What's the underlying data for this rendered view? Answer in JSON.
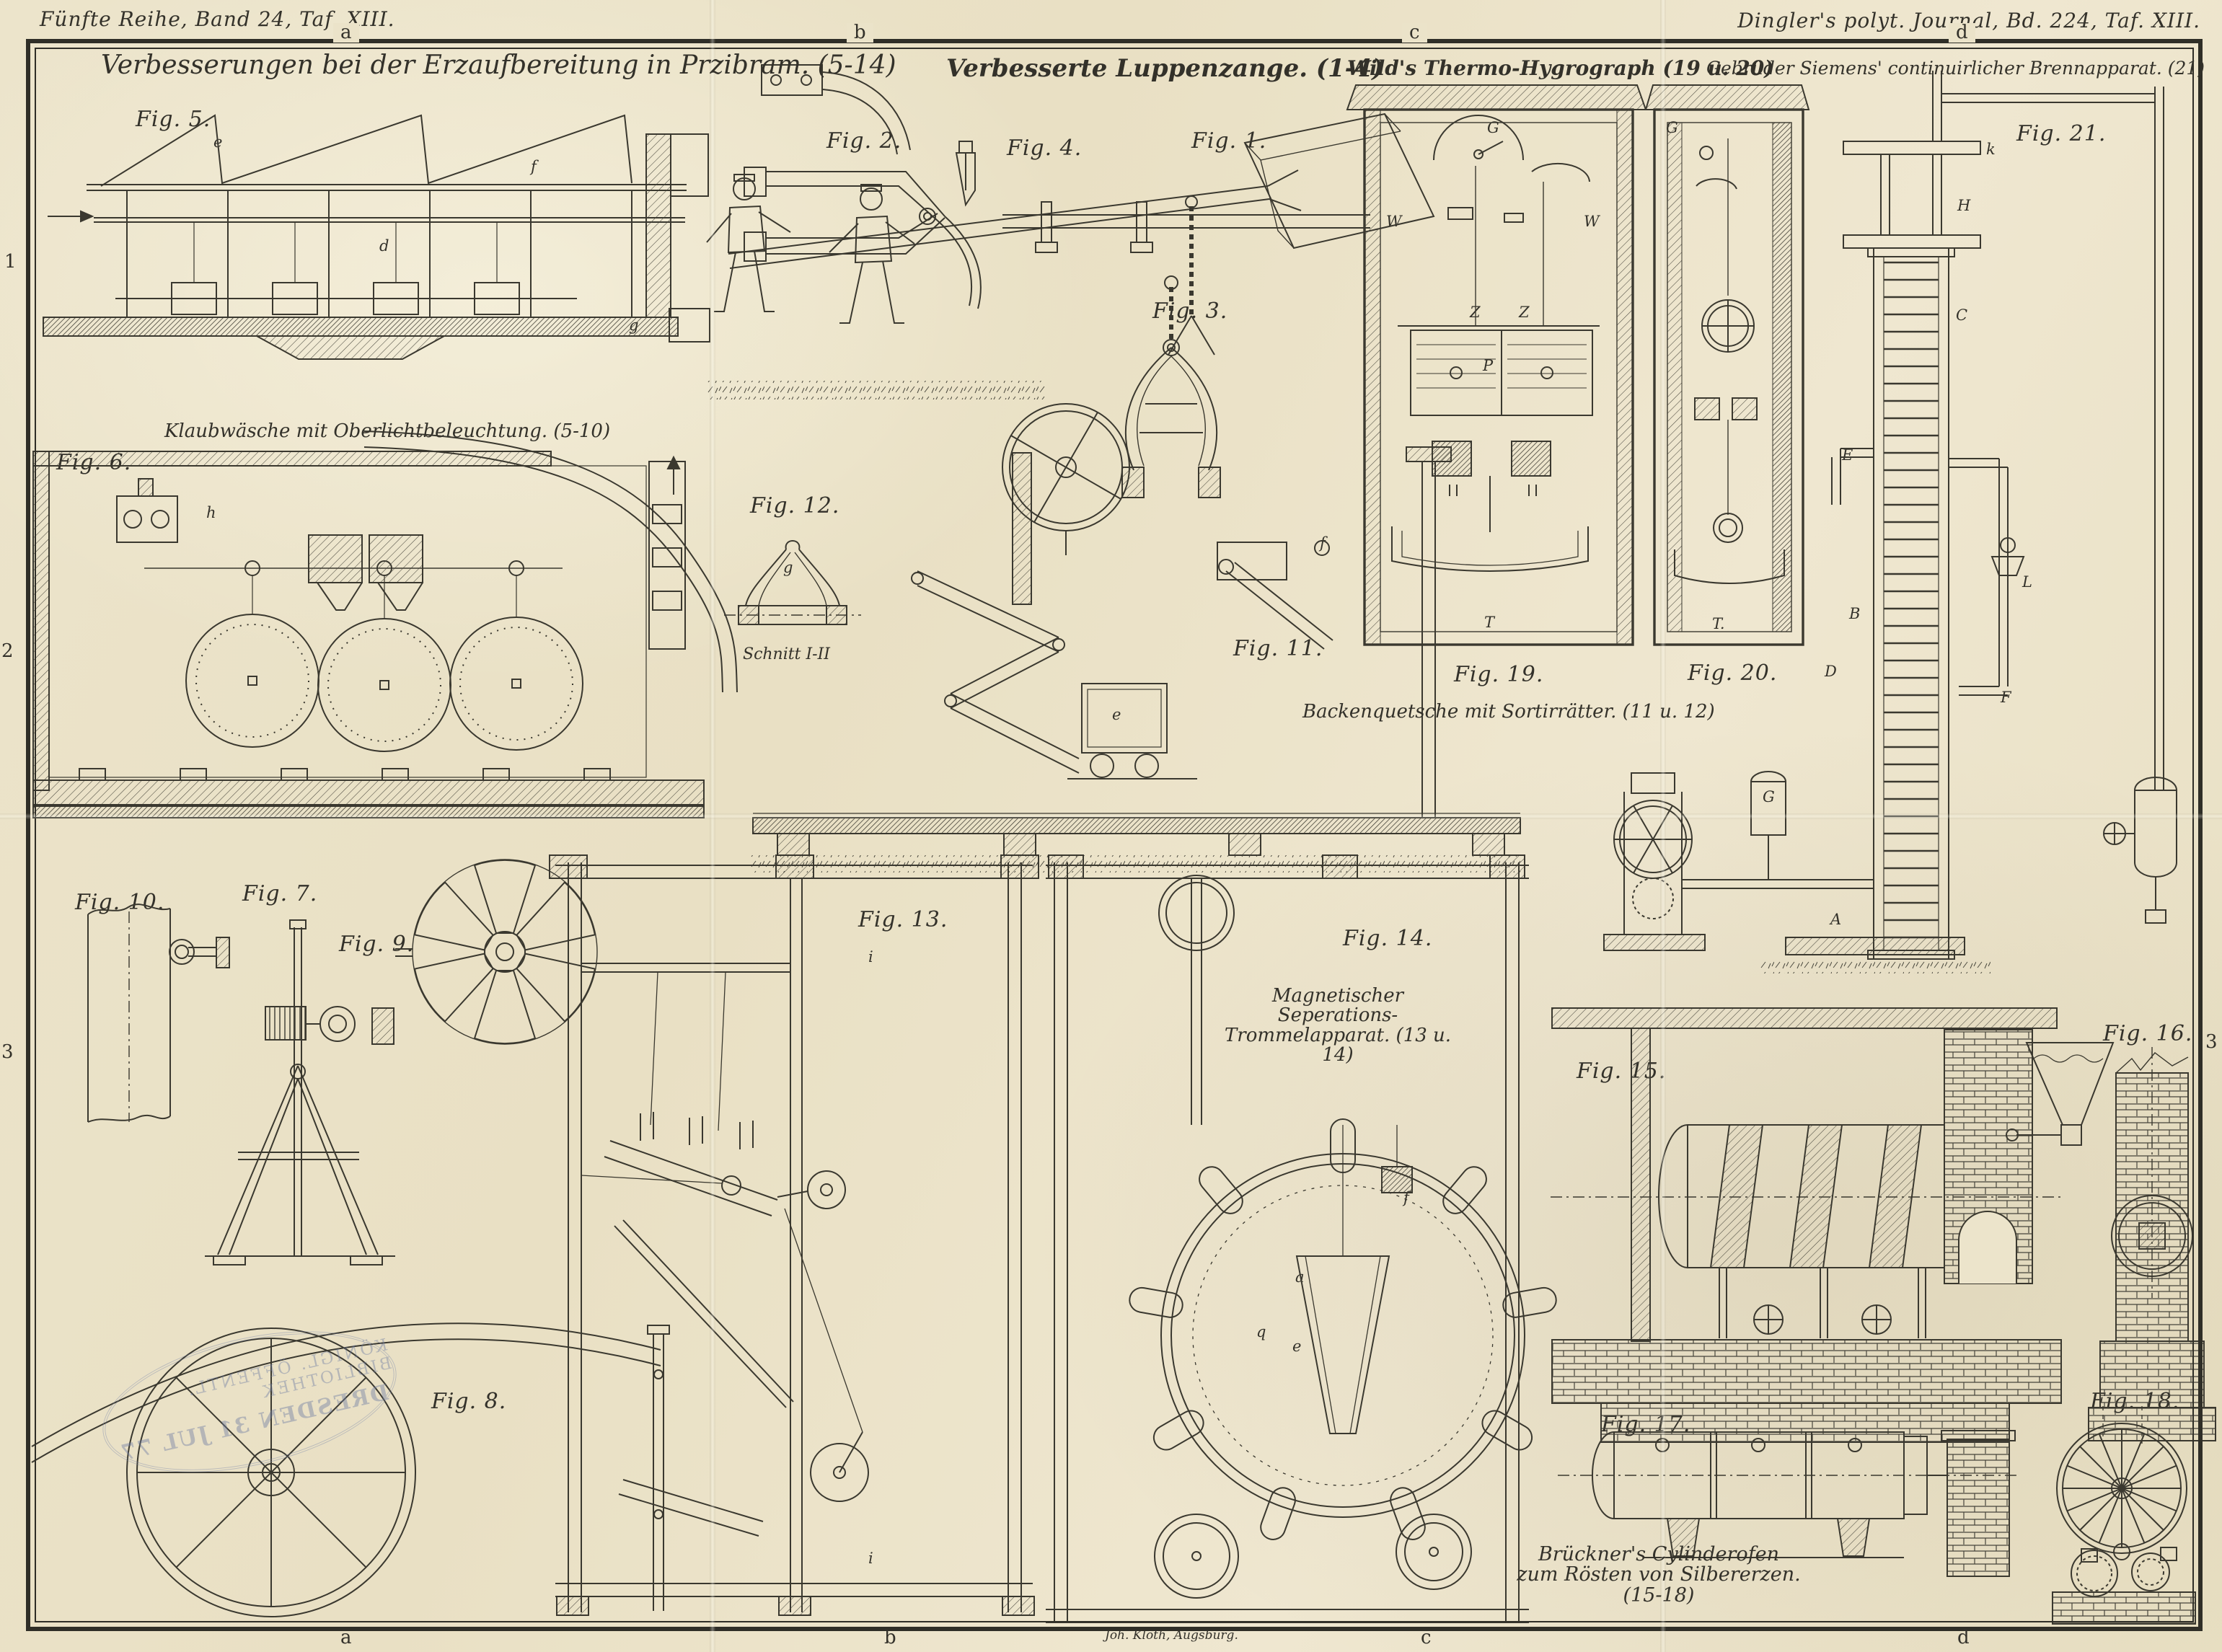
{
  "plate": {
    "paper_color": "#ebe3c9",
    "ink_color": "#33312a",
    "margin_top_left": "Fünfte Reihe, Band 24, Taf. XIII.",
    "margin_top_right": "Dingler's polyt. Journal, Bd. 224, Taf. XIII.",
    "printer_credit": "Joh. Kloth, Augsburg."
  },
  "headings": {
    "erzaufbereitung": "Verbesserungen bei der Erzaufbereitung in Przibram. (5-14)",
    "luppenzange": "Verbesserte Luppenzange. (1-4)",
    "thermo_hygrograph": "Wild's Thermo-Hygrograph (19 u. 20)",
    "brennapparat": "Gebrüder Siemens' continuirlicher Brennapparat. (21)"
  },
  "captions": {
    "klaubwaesche": "Klaubwäsche mit Oberlichtbeleuchtung. (5-10)",
    "backenquetsche": "Backenquetsche mit Sortirrätter. (11 u. 12)",
    "magnet_trommel_line1": "Magnetischer Seperations-",
    "magnet_trommel_line2": "Trommelapparat. (13 u. 14)",
    "cylinderofen_line1": "Brückner's Cylinderofen",
    "cylinderofen_line2": "zum Rösten von Silbererzen. (15-18)",
    "schnitt": "Schnitt I-II"
  },
  "figures": [
    "Fig. 1.",
    "Fig. 2.",
    "Fig. 3.",
    "Fig. 4.",
    "Fig. 5.",
    "Fig. 6.",
    "Fig. 7.",
    "Fig. 8.",
    "Fig. 9.",
    "Fig. 10.",
    "Fig. 11.",
    "Fig. 12.",
    "Fig. 13.",
    "Fig. 14.",
    "Fig. 15.",
    "Fig. 16.",
    "Fig. 17.",
    "Fig. 18.",
    "Fig. 19.",
    "Fig. 20.",
    "Fig. 21."
  ],
  "markers": {
    "top": [
      "a",
      "b",
      "c",
      "d"
    ],
    "bottom": [
      "a",
      "b",
      "c",
      "d"
    ],
    "left": [
      "1",
      "2",
      "3"
    ],
    "right": [
      "3"
    ]
  },
  "part_letters": [
    "g",
    "G",
    "T",
    "W",
    "W",
    "Z",
    "Z",
    "P",
    "T.",
    "G",
    "k",
    "H",
    "C",
    "E",
    "B",
    "D",
    "F",
    "L",
    "G",
    "A",
    "a",
    "e",
    "q",
    "f",
    "i",
    "i",
    "d",
    "e",
    "f",
    "g",
    "e",
    "f",
    "h"
  ],
  "stamp": {
    "line1": "KÖNIGL. ÖFFENTL. BIBLIOTHEK",
    "line2": "DRESDEN 31 JUL 77"
  }
}
